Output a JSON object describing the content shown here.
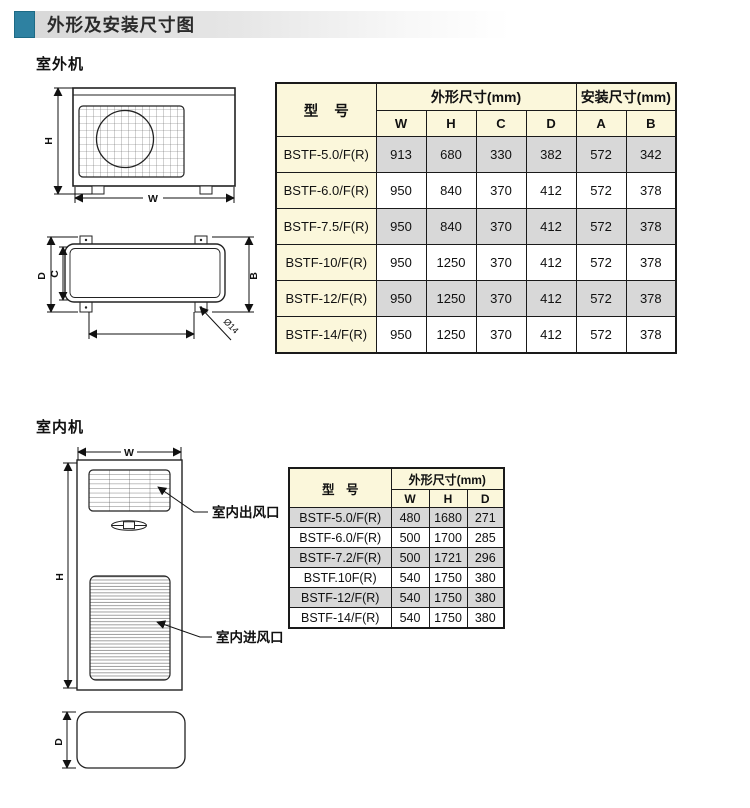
{
  "page": {
    "title": "外形及安装尺寸图"
  },
  "colors": {
    "accent_teal": "#2e81a1",
    "header_cream": "#fbf7db",
    "row_gray": "#d8d8d8",
    "border": "#1a1a1a"
  },
  "outdoor": {
    "section_label": "室外机",
    "drawing": {
      "front": {
        "width_label": "W",
        "height_label": "H"
      },
      "top": {
        "depth_label": "D",
        "inner_depth_label": "C",
        "install_label": "B",
        "hole_label": "Ø14"
      }
    },
    "table": {
      "model_header": "型 号",
      "dim_group_header": "外形尺寸(mm)",
      "install_group_header": "安装尺寸(mm)",
      "dim_columns": [
        "W",
        "H",
        "C",
        "D"
      ],
      "install_columns": [
        "A",
        "B"
      ],
      "rows": [
        {
          "model": "BSTF-5.0/F(R)",
          "values": [
            "913",
            "680",
            "330",
            "382",
            "572",
            "342"
          ]
        },
        {
          "model": "BSTF-6.0/F(R)",
          "values": [
            "950",
            "840",
            "370",
            "412",
            "572",
            "378"
          ]
        },
        {
          "model": "BSTF-7.5/F(R)",
          "values": [
            "950",
            "840",
            "370",
            "412",
            "572",
            "378"
          ]
        },
        {
          "model": "BSTF-10/F(R)",
          "values": [
            "950",
            "1250",
            "370",
            "412",
            "572",
            "378"
          ]
        },
        {
          "model": "BSTF-12/F(R)",
          "values": [
            "950",
            "1250",
            "370",
            "412",
            "572",
            "378"
          ]
        },
        {
          "model": "BSTF-14/F(R)",
          "values": [
            "950",
            "1250",
            "370",
            "412",
            "572",
            "378"
          ]
        }
      ]
    }
  },
  "indoor": {
    "section_label": "室内机",
    "drawing": {
      "width_label": "W",
      "height_label": "H",
      "depth_label": "D",
      "outlet_label": "室内出风口",
      "inlet_label": "室内进风口"
    },
    "table": {
      "model_header": "型 号",
      "dim_group_header": "外形尺寸(mm)",
      "dim_columns": [
        "W",
        "H",
        "D"
      ],
      "rows": [
        {
          "model": "BSTF-5.0/F(R)",
          "values": [
            "480",
            "1680",
            "271"
          ]
        },
        {
          "model": "BSTF-6.0/F(R)",
          "values": [
            "500",
            "1700",
            "285"
          ]
        },
        {
          "model": "BSTF-7.2/F(R)",
          "values": [
            "500",
            "1721",
            "296"
          ]
        },
        {
          "model": "BSTF.10F(R)",
          "values": [
            "540",
            "1750",
            "380"
          ]
        },
        {
          "model": "BSTF-12/F(R)",
          "values": [
            "540",
            "1750",
            "380"
          ]
        },
        {
          "model": "BSTF-14/F(R)",
          "values": [
            "540",
            "1750",
            "380"
          ]
        }
      ]
    }
  }
}
